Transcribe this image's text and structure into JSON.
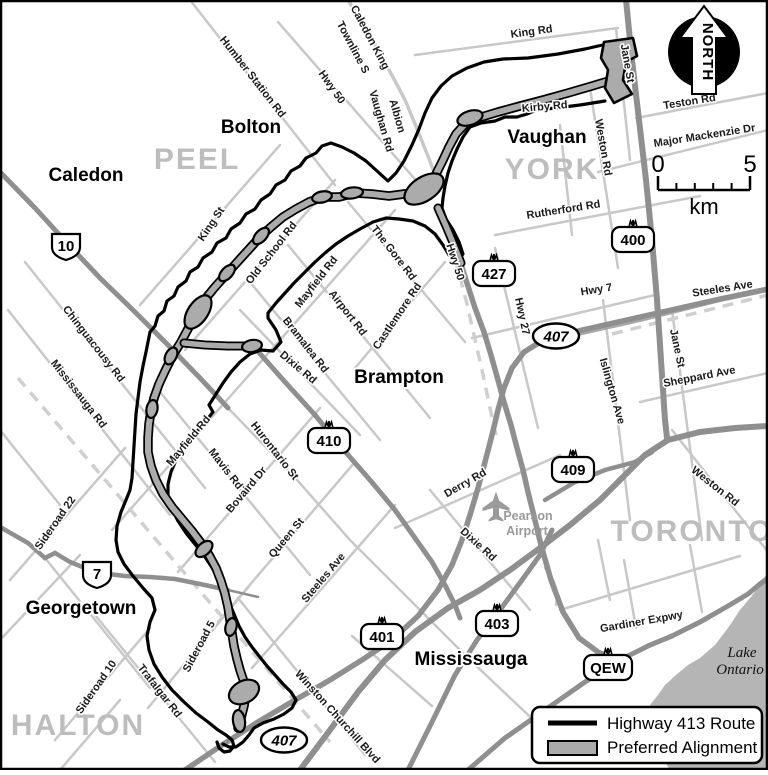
{
  "title": "Highway 413 Route Map",
  "colors": {
    "road_minor": "#c8c8c8",
    "road_mid": "#a8a8a8",
    "road_major": "#8f8f8f",
    "route": "#000000",
    "alignment_fill": "#ababab",
    "region_text": "#bdbdbd",
    "water": "#b5b5b5",
    "muted_text": "#9a9a9a"
  },
  "legend": {
    "items": [
      {
        "label": "Highway 413 Route",
        "swatch": "line"
      },
      {
        "label": "Preferred Alignment",
        "swatch": "band"
      }
    ]
  },
  "north_arrow": {
    "label": "NORTH"
  },
  "scale_bar": {
    "start": "0",
    "end": "5",
    "unit": "km"
  },
  "water": {
    "name_lines": [
      "Lake",
      "Ontario"
    ]
  },
  "airport": {
    "name_lines": [
      "Pearson",
      "Airport"
    ],
    "icon": "airplane-icon",
    "x": 496,
    "y": 505
  },
  "regions": [
    {
      "name": "PEEL",
      "x": 197,
      "y": 169
    },
    {
      "name": "YORK",
      "x": 552,
      "y": 179
    },
    {
      "name": "HALTON",
      "x": 78,
      "y": 735
    },
    {
      "name": "TORONTO",
      "x": 692,
      "y": 541
    }
  ],
  "cities": [
    {
      "name": "Bolton",
      "x": 251,
      "y": 133
    },
    {
      "name": "Caledon",
      "x": 86,
      "y": 181
    },
    {
      "name": "Vaughan",
      "x": 547,
      "y": 143
    },
    {
      "name": "Brampton",
      "x": 399,
      "y": 383
    },
    {
      "name": "Georgetown",
      "x": 81,
      "y": 614
    },
    {
      "name": "Mississauga",
      "x": 471,
      "y": 665
    }
  ],
  "road_labels": [
    {
      "text": "Humber Station Rd",
      "x": 250,
      "y": 79,
      "r": 52
    },
    {
      "text": "Hwy 50",
      "x": 329,
      "y": 89,
      "r": 55
    },
    {
      "text": "Caledon King",
      "x": 367,
      "y": 39,
      "r": 62
    },
    {
      "text": "Townline S",
      "x": 350,
      "y": 49,
      "r": 62
    },
    {
      "text": "Albion",
      "x": 394,
      "y": 117,
      "r": 74
    },
    {
      "text": "Vaughan Rd",
      "x": 378,
      "y": 122,
      "r": 74
    },
    {
      "text": "King St",
      "x": 214,
      "y": 226,
      "r": -56
    },
    {
      "text": "Old School Rd",
      "x": 274,
      "y": 255,
      "r": -52
    },
    {
      "text": "Mayfield Rd",
      "x": 319,
      "y": 284,
      "r": -52
    },
    {
      "text": "The Gore Rd",
      "x": 391,
      "y": 255,
      "r": 52
    },
    {
      "text": "Airport Rd",
      "x": 345,
      "y": 315,
      "r": 52
    },
    {
      "text": "Bramalea Rd",
      "x": 303,
      "y": 347,
      "r": 52
    },
    {
      "text": "Dixie Rd",
      "x": 296,
      "y": 370,
      "r": 40
    },
    {
      "text": "Castlemore Rd",
      "x": 400,
      "y": 318,
      "r": -56
    },
    {
      "text": "Hwy 50",
      "x": 452,
      "y": 263,
      "r": 72
    },
    {
      "text": "Hwy 27",
      "x": 519,
      "y": 317,
      "r": 78
    },
    {
      "text": "Mayfield Rd",
      "x": 191,
      "y": 443,
      "r": -50
    },
    {
      "text": "Hurontario St",
      "x": 272,
      "y": 453,
      "r": 52
    },
    {
      "text": "Mavis Rd",
      "x": 223,
      "y": 471,
      "r": 52
    },
    {
      "text": "Bovaird Dr",
      "x": 249,
      "y": 492,
      "r": -50
    },
    {
      "text": "Queen St",
      "x": 289,
      "y": 540,
      "r": -50
    },
    {
      "text": "Steeles Ave",
      "x": 326,
      "y": 580,
      "r": -50
    },
    {
      "text": "Chinguacousy Rd",
      "x": 91,
      "y": 346,
      "r": 52
    },
    {
      "text": "Mississauga Rd",
      "x": 76,
      "y": 396,
      "r": 52
    },
    {
      "text": "Sideroad 22",
      "x": 58,
      "y": 525,
      "r": -55
    },
    {
      "text": "Sideroad 10",
      "x": 99,
      "y": 689,
      "r": -55
    },
    {
      "text": "Trafalgar Rd",
      "x": 157,
      "y": 693,
      "r": 52
    },
    {
      "text": "Sideroad 5",
      "x": 202,
      "y": 648,
      "r": -62
    },
    {
      "text": "Winston Churchill Blvd",
      "x": 335,
      "y": 719,
      "r": 48
    },
    {
      "text": "Derry Rd",
      "x": 467,
      "y": 486,
      "r": -30
    },
    {
      "text": "Dixie Rd",
      "x": 476,
      "y": 547,
      "r": 42
    },
    {
      "text": "Kirby Rd",
      "x": 545,
      "y": 110,
      "r": -5
    },
    {
      "text": "King Rd",
      "x": 532,
      "y": 35,
      "r": -8
    },
    {
      "text": "Jane St",
      "x": 624,
      "y": 64,
      "r": 80
    },
    {
      "text": "Weston Rd",
      "x": 600,
      "y": 148,
      "r": 80
    },
    {
      "text": "Teston Rd",
      "x": 690,
      "y": 105,
      "r": -9
    },
    {
      "text": "Major Mackenzie Dr",
      "x": 705,
      "y": 139,
      "r": -9
    },
    {
      "text": "Rutherford Rd",
      "x": 564,
      "y": 213,
      "r": -9
    },
    {
      "text": "Hwy 7",
      "x": 597,
      "y": 293,
      "r": -9
    },
    {
      "text": "Steeles Ave",
      "x": 723,
      "y": 292,
      "r": -9
    },
    {
      "text": "Jane St",
      "x": 674,
      "y": 349,
      "r": 78
    },
    {
      "text": "Sheppard Ave",
      "x": 700,
      "y": 380,
      "r": -11
    },
    {
      "text": "Islington Ave",
      "x": 609,
      "y": 392,
      "r": 74
    },
    {
      "text": "Weston Rd",
      "x": 713,
      "y": 489,
      "r": 38
    },
    {
      "text": "Gardiner Expwy",
      "x": 642,
      "y": 625,
      "r": -10
    }
  ],
  "shields": {
    "crown": [
      {
        "text": "400",
        "x": 633,
        "y": 239
      },
      {
        "text": "427",
        "x": 494,
        "y": 273
      },
      {
        "text": "410",
        "x": 329,
        "y": 440
      },
      {
        "text": "409",
        "x": 573,
        "y": 469
      },
      {
        "text": "401",
        "x": 382,
        "y": 636
      },
      {
        "text": "403",
        "x": 497,
        "y": 623
      },
      {
        "text": "QEW",
        "x": 608,
        "y": 667
      }
    ],
    "oval": [
      {
        "text": "407",
        "x": 556,
        "y": 336
      },
      {
        "text": "407",
        "x": 284,
        "y": 740
      }
    ],
    "provincial": [
      {
        "text": "10",
        "x": 66,
        "y": 246
      },
      {
        "text": "7",
        "x": 97,
        "y": 574
      }
    ]
  }
}
